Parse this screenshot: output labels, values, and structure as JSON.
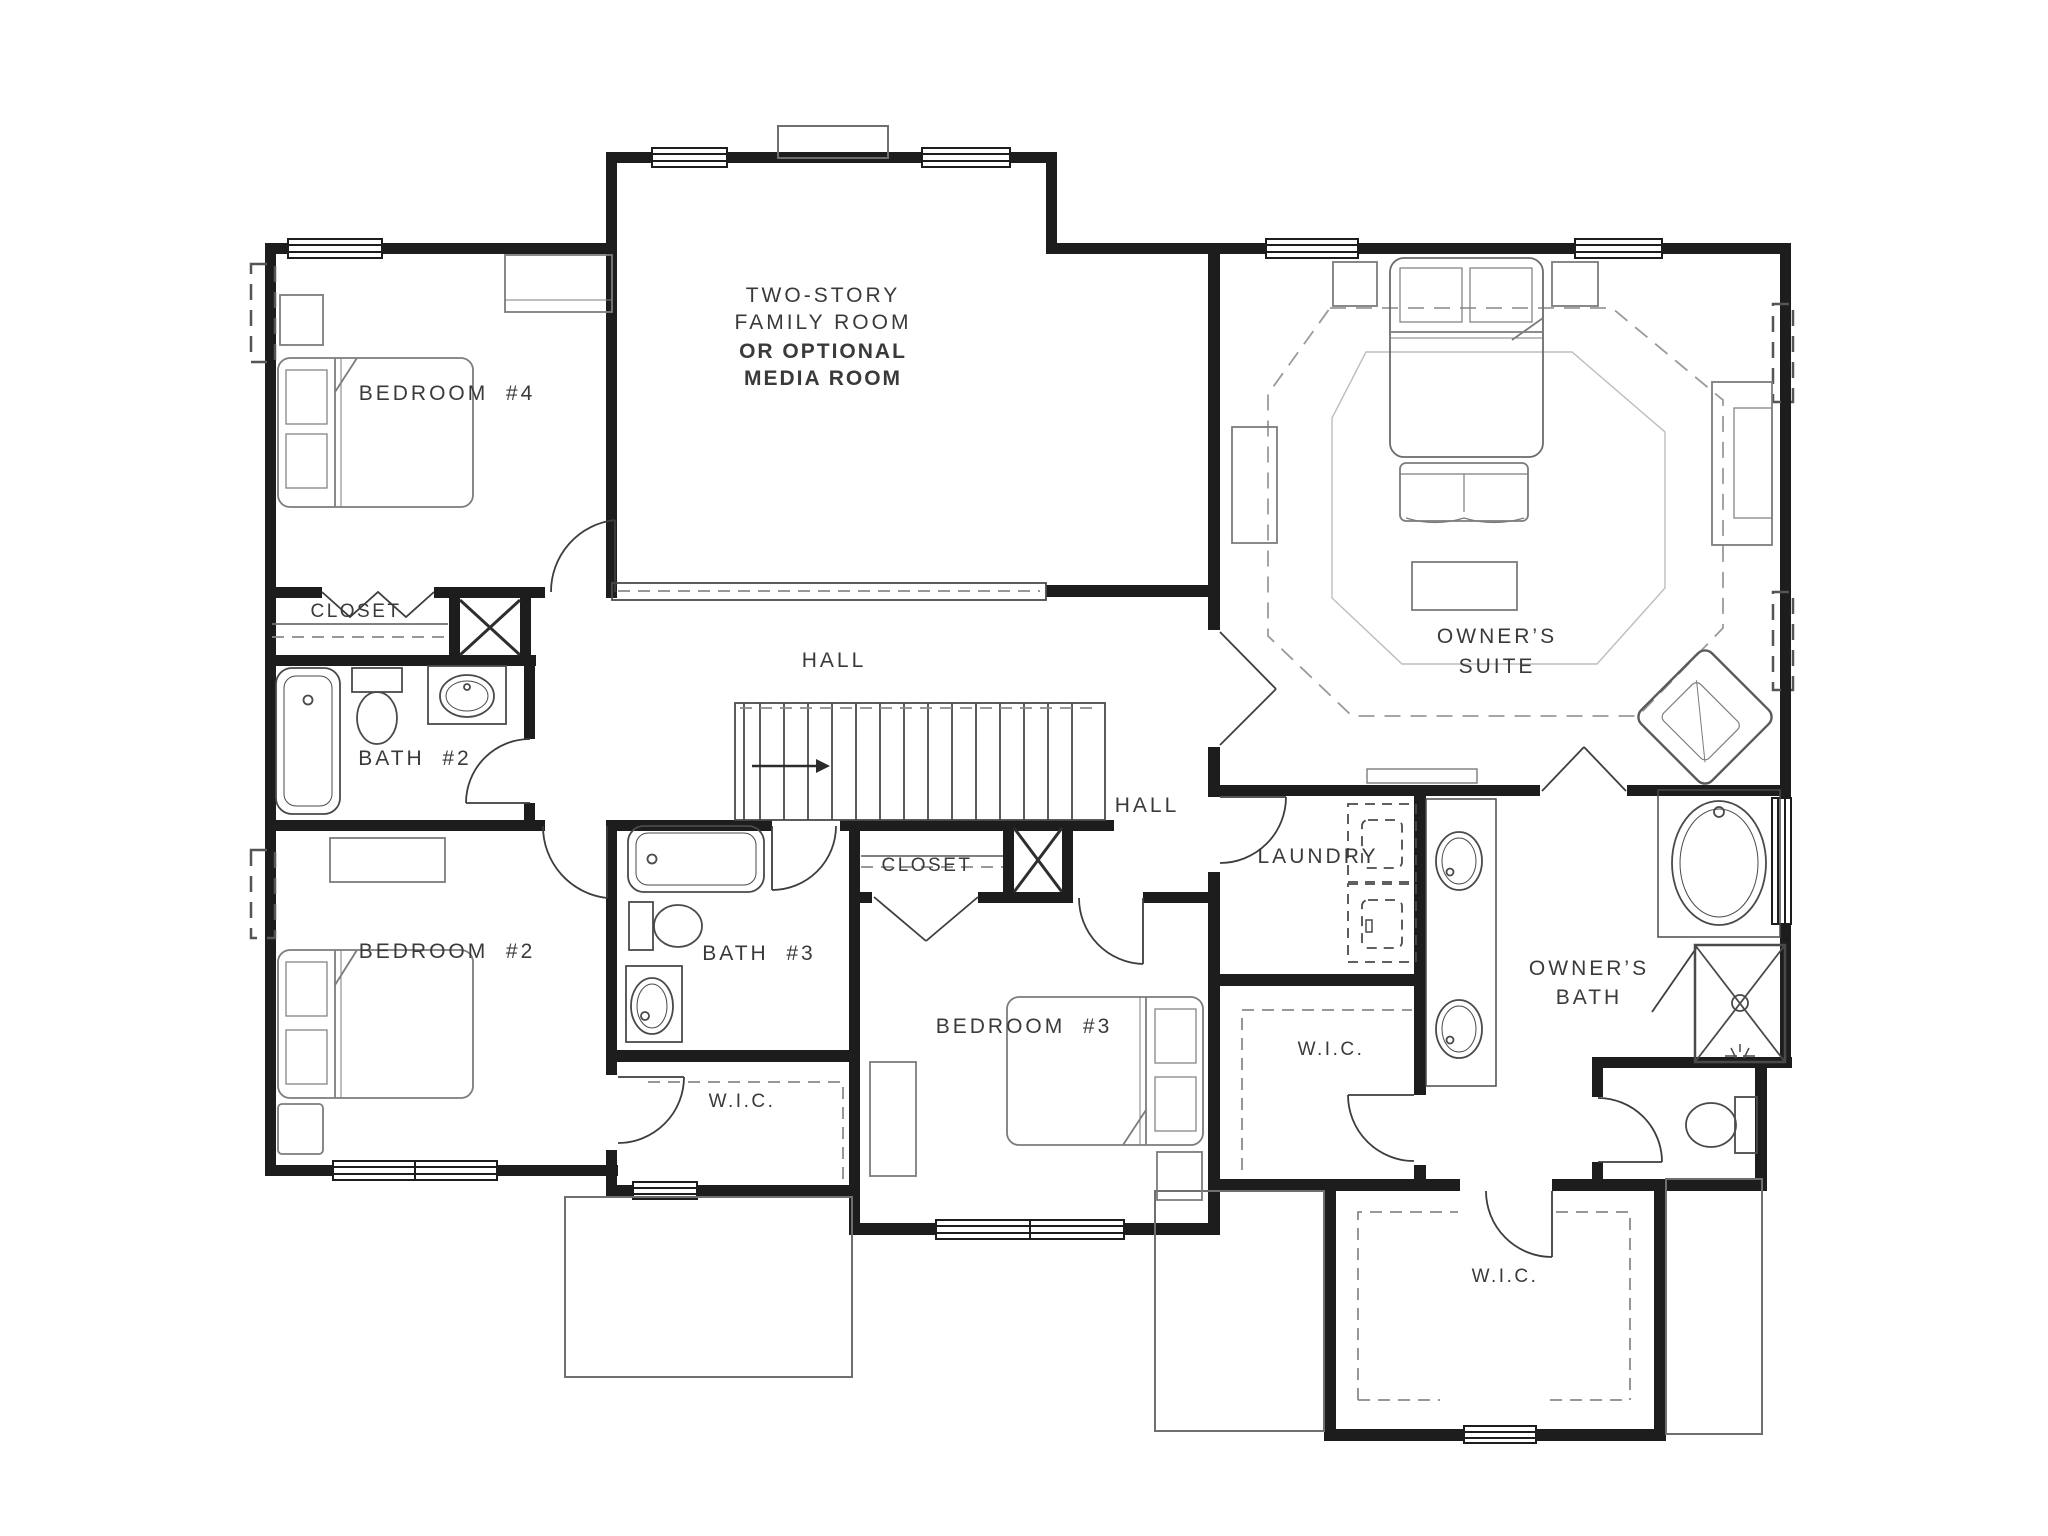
{
  "plan": {
    "type": "architectural-floor-plan",
    "floor": "second-floor",
    "rooms": {
      "family_room": {
        "line1": "TWO-STORY",
        "line2": "FAMILY ROOM",
        "line3": "OR OPTIONAL",
        "line4": "MEDIA ROOM"
      },
      "bedroom4": {
        "label": "BEDROOM  #4"
      },
      "bedroom2": {
        "label": "BEDROOM  #2"
      },
      "bedroom3": {
        "label": "BEDROOM  #3"
      },
      "bath2": {
        "label": "BATH  #2"
      },
      "bath3": {
        "label": "BATH  #3"
      },
      "closet_bedroom4": {
        "label": "CLOSET"
      },
      "closet_bedroom3": {
        "label": "CLOSET"
      },
      "hall_west": {
        "label": "HALL"
      },
      "hall_east": {
        "label": "HALL"
      },
      "laundry": {
        "label": "LAUNDRY"
      },
      "owners_suite": {
        "line1": "OWNER’S",
        "line2": "SUITE"
      },
      "owners_bath": {
        "line1": "OWNER’S",
        "line2": "BATH"
      },
      "wic_bedroom2": {
        "label": "W.I.C."
      },
      "wic_hall": {
        "label": "W.I.C."
      },
      "wic_owners": {
        "label": "W.I.C."
      }
    },
    "colors": {
      "wall": "#1d1d1d",
      "fixture": "#4a4a4a",
      "furniture": "#787878",
      "dash": "#8a8a8a",
      "text": "#3a3a3a"
    }
  }
}
